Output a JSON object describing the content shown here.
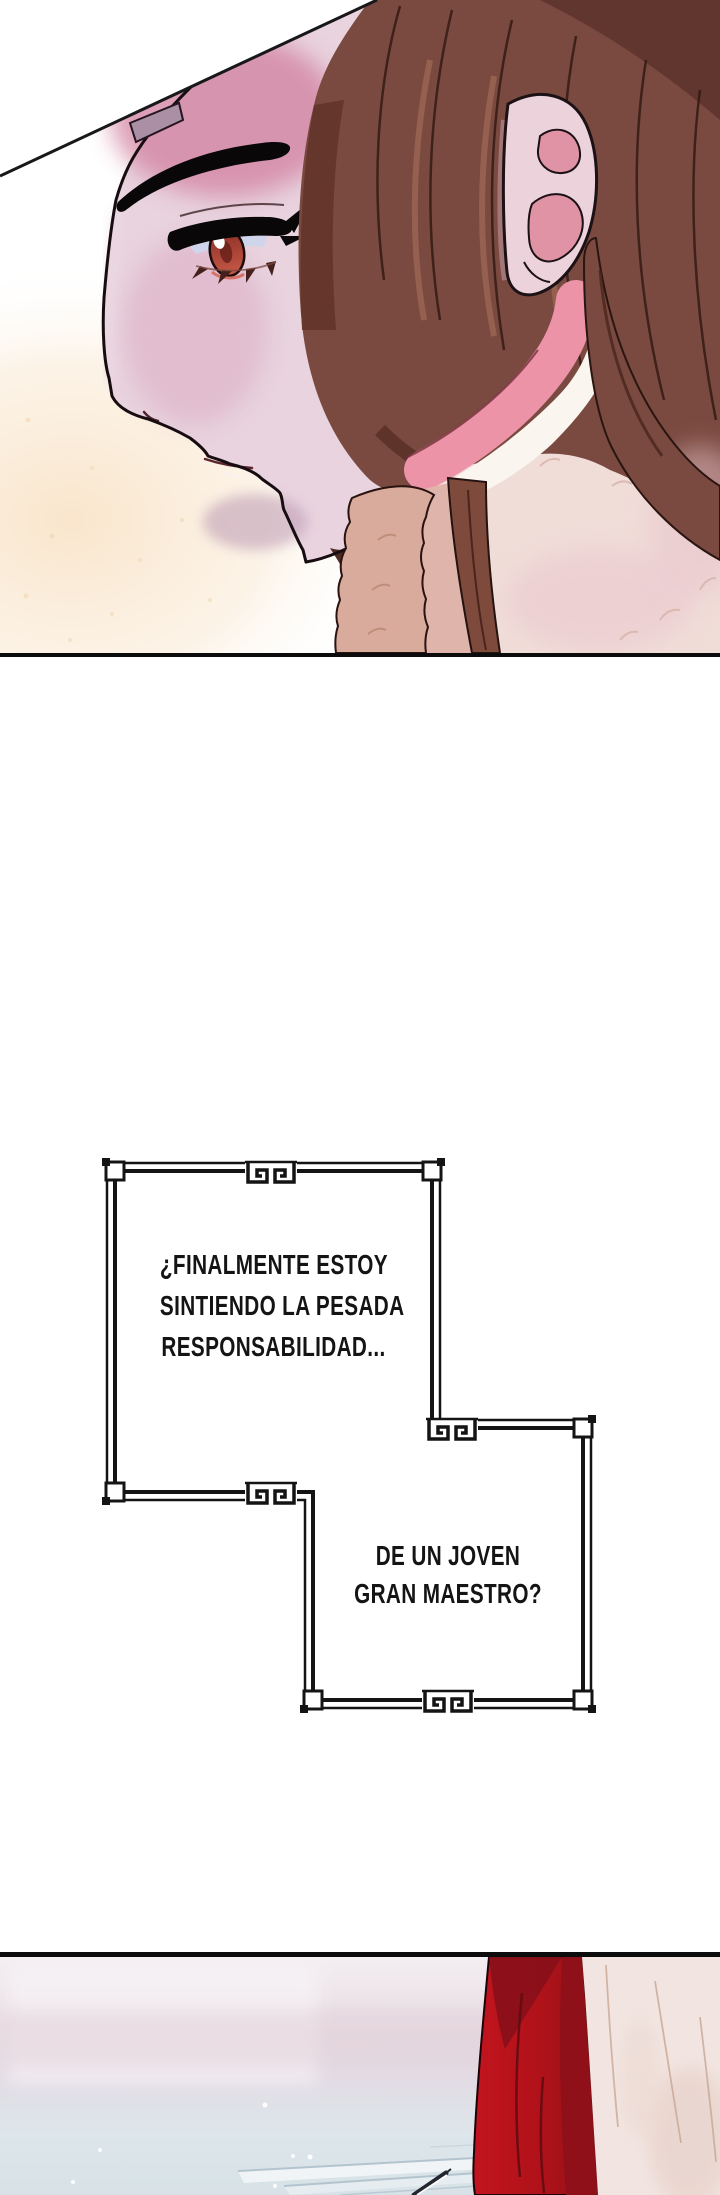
{
  "page": {
    "kind": "webtoon episode page",
    "background": "#ffffff"
  },
  "speech_box": {
    "compartment_top": {
      "lines": [
        "¿FINALMENTE ESTOY",
        "SINTIENDO LA PESADA",
        "RESPONSABILIDAD..."
      ]
    },
    "compartment_bottom": {
      "lines": [
        "DE UN JOVEN",
        "GRAN MAESTRO?"
      ]
    },
    "border_color": "#141414",
    "text_color": "#141414"
  },
  "panel_top": {
    "subject": "close-up left profile of a long brown-haired character with fur collar",
    "palette": {
      "outline": "#170d10",
      "skin_light": "#e8d3de",
      "skin_pink": "#d495ae",
      "skin_shadow": "#b99bb3",
      "hair": "#7a4a40",
      "hair_shadow": "#5c332d",
      "hair_highlight": "#9a6552",
      "iris": "#a63c30",
      "sclera": "#cfd6ec",
      "ear_inner": "#e093a4",
      "collar_pink": "#ed93a8",
      "fur_white": "#faf5ef",
      "garment_cream": "#f0ddd8",
      "neck_strand": "#7e4a3c",
      "fur_tan": "#d8ab9c",
      "glow": "#f9e4c9",
      "talisman": "#ab8fa4"
    }
  },
  "panel_bottom": {
    "subject": "pale room with red drape, cream curtain, floor steps and a thin pin",
    "palette": {
      "wall_top": "#f3eef2",
      "wall_pink": "#e2cfd8",
      "floor": "#d7e2e7",
      "step_line": "#b3c4ce",
      "drape_red": "#c2141f",
      "drape_red_dark": "#8e1118",
      "curtain_cream": "#f2e5e1",
      "fold_line": "#c9a795",
      "sparkle": "#ffffff"
    }
  },
  "borders": {
    "panel_border": "#0c0c0c"
  }
}
